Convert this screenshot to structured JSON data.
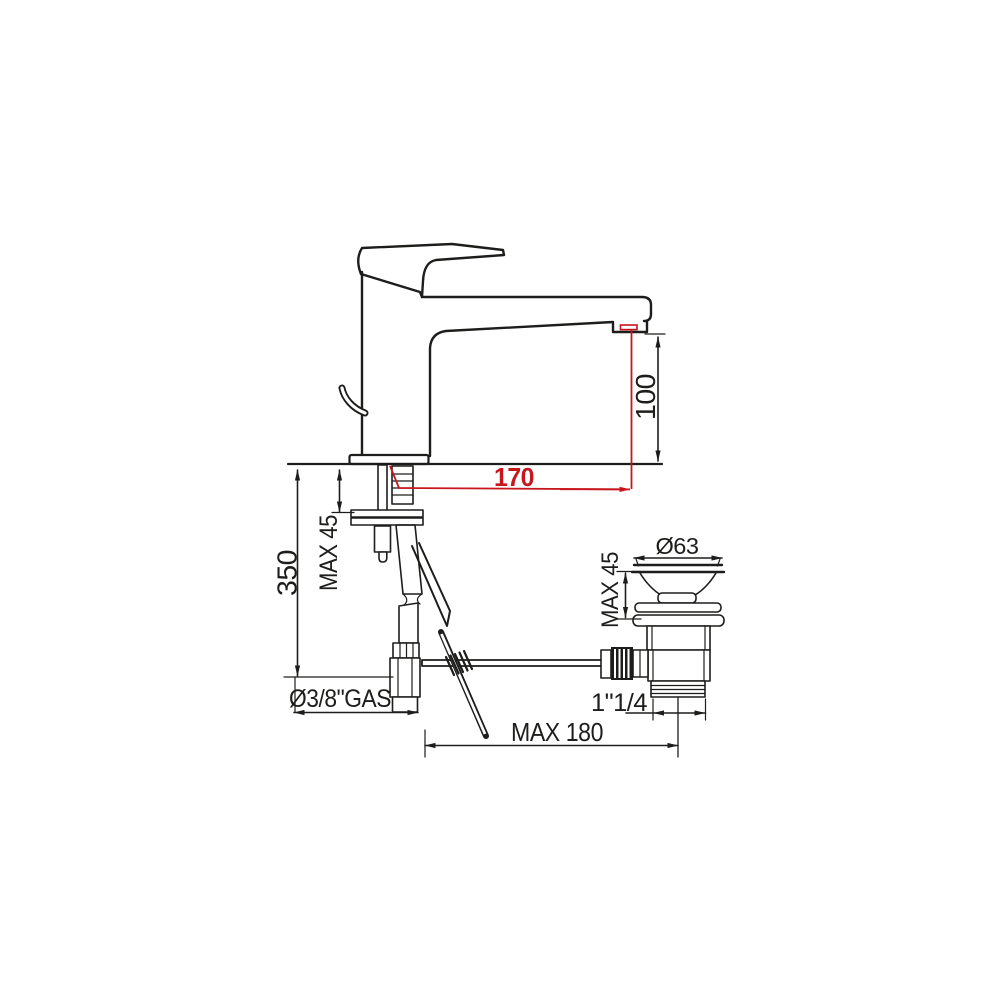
{
  "meta": {
    "title": "Basin mixer tap with pop-up waste - dimensional technical drawing",
    "drawing_type": "technical-drawing"
  },
  "colors": {
    "line": "#1d1d1b",
    "dimension_red": "#c8161d",
    "background": "#ffffff"
  },
  "labels": {
    "hose_length": "350",
    "deck_thickness_max": "MAX 45",
    "spout_height": "100",
    "spout_reach": "170",
    "inlet_thread": "Ø3/8\"GAS",
    "rod_reach_max": "MAX 180",
    "waste_outlet_thread": "1\"1/4",
    "waste_flange_diameter": "Ø63",
    "waste_deck_max": "MAX 45"
  },
  "dimensions": [
    {
      "label": "350",
      "axis": "vertical",
      "color": "black"
    },
    {
      "label": "MAX 45",
      "axis": "vertical",
      "color": "black"
    },
    {
      "label": "100",
      "axis": "vertical",
      "color": "black"
    },
    {
      "label": "170",
      "axis": "horizontal",
      "color": "red"
    },
    {
      "label": "Ø3/8\"GAS",
      "axis": "horizontal",
      "color": "black"
    },
    {
      "label": "MAX 180",
      "axis": "horizontal",
      "color": "black"
    },
    {
      "label": "1\"1/4",
      "axis": "horizontal",
      "color": "black"
    },
    {
      "label": "Ø63",
      "axis": "horizontal",
      "color": "black"
    },
    {
      "label": "MAX 45",
      "axis": "vertical",
      "color": "black"
    }
  ]
}
